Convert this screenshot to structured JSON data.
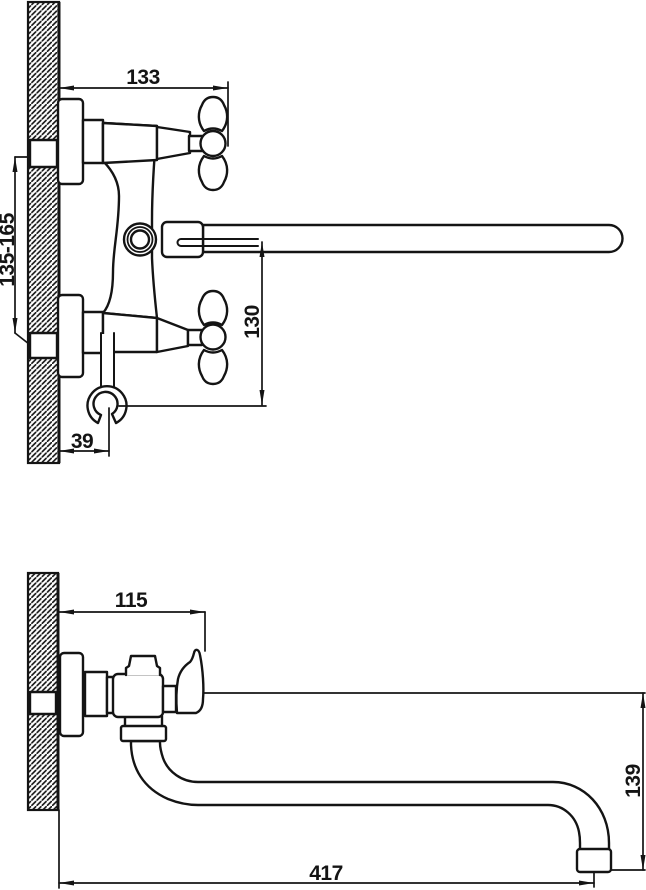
{
  "drawing": {
    "type": "technical dimension drawing",
    "subject": "wall-mounted two-handle mixer faucet, two orthographic views",
    "background_color": "#ffffff",
    "line_color": "#141414",
    "views": [
      {
        "id": "front-view",
        "description": "front projection: hatched wall section, two cross handles, diverter button, long straight spout, shower hook",
        "dimensions": [
          {
            "id": "dim-wall-to-handle",
            "value": "133",
            "orientation": "horizontal"
          },
          {
            "id": "dim-supply-spacing",
            "value": "135-165",
            "orientation": "vertical"
          },
          {
            "id": "dim-spout-to-hook",
            "value": "130",
            "orientation": "vertical"
          },
          {
            "id": "dim-wall-to-hook",
            "value": "39",
            "orientation": "horizontal"
          }
        ]
      },
      {
        "id": "side-view",
        "description": "side projection: hatched wall section, valve body with diverter knob, S-curved spout with aerator",
        "dimensions": [
          {
            "id": "dim-body-depth",
            "value": "115",
            "orientation": "horizontal"
          },
          {
            "id": "dim-spout-drop",
            "value": "139",
            "orientation": "vertical"
          },
          {
            "id": "dim-spout-reach",
            "value": "417",
            "orientation": "horizontal"
          }
        ]
      }
    ]
  }
}
